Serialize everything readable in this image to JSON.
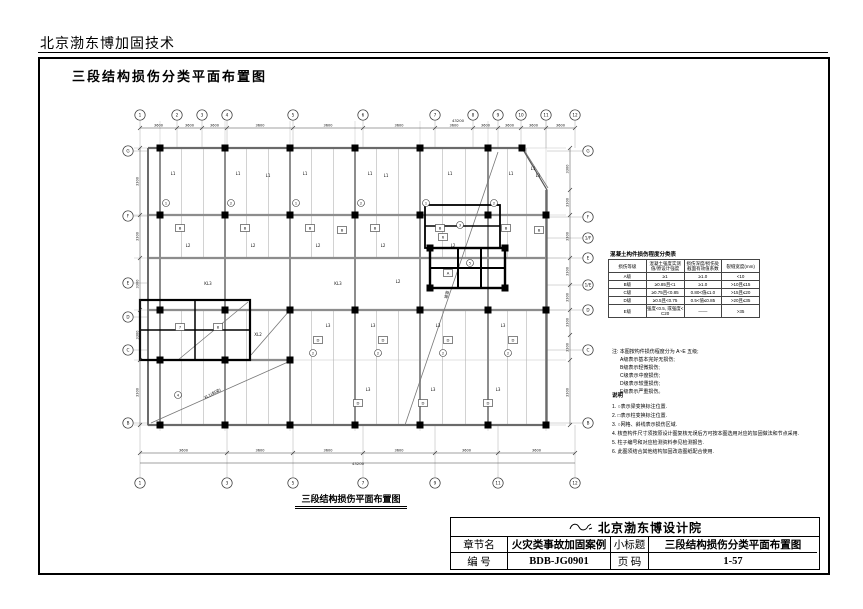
{
  "page": {
    "header_text": "北京渤东博加固技术"
  },
  "drawing": {
    "title": "三段结构损伤分类平面布置图"
  },
  "class_table": {
    "title": "混凝土构件损伤程度分类表",
    "headers": [
      "损伤等级",
      "混凝土强度实测值/原设计强度",
      "损伤深度/损伤处截面有效值系数",
      "裂缝宽度(mm)"
    ],
    "rows": [
      [
        "A级",
        "≥1",
        "≥1.0",
        "<10"
      ],
      [
        "B级",
        "≥0.85且<1",
        "≥1.0",
        ">10且≤15"
      ],
      [
        "C级",
        "≥0.75且<0.85",
        "0.80<值≤1.0",
        ">15且≤20"
      ],
      [
        "D级",
        "≥0.5且<0.75",
        "0.5<值≤0.85",
        ">20且≤35"
      ],
      [
        "E级",
        "强度<0.5, 或强度<C20",
        "——",
        ">35"
      ]
    ]
  },
  "notes": {
    "lead": "注: 本图按构件损伤程度分为 A~E 五级;",
    "items": [
      "A级表示基本完好无损伤;",
      "B级表示轻微损伤;",
      "C级表示中度损伤;",
      "D级表示较重损伤;",
      "E级表示严重损伤。"
    ]
  },
  "legend": {
    "title": "说明",
    "items": [
      "1. ○表示梁变换标注位置.",
      "2. □表示柱变换标注位置.",
      "3. ○网格、斜线表示损伤区域.",
      "4. 核查构件尺寸须按原设计图复核无误后方可按本图选用对应的加固做法和节点采用.",
      "5. 柱子编号和对应检测资料参见检测报告.",
      "6. 此图须结合其他结构加固改造图纸配合使用."
    ]
  },
  "titleblock": {
    "company": "北京渤东博设计院",
    "chapter_label": "章节名",
    "chapter": "火灾类事故加固案例",
    "subtitle_label": "小标题",
    "subtitle": "三段结构损伤分类平面布置图",
    "number_label": "编  号",
    "number": "BDB-JG0901",
    "page_label": "页  码",
    "page": "1-57"
  },
  "plan": {
    "caption": "三段结构损伤平面布置图",
    "beams": {
      "main_x": [
        42,
        107,
        172,
        237,
        302,
        370,
        428
      ],
      "main_y": [
        53,
        120,
        163,
        215,
        265,
        330
      ],
      "h": [
        [
          30,
          53,
          404
        ],
        [
          30,
          120,
          429
        ],
        [
          30,
          163,
          429
        ],
        [
          30,
          215,
          429
        ],
        [
          30,
          265,
          172
        ],
        [
          30,
          330,
          429
        ]
      ],
      "v": [
        [
          30,
          53,
          330
        ],
        [
          42,
          53,
          330
        ],
        [
          107,
          53,
          330
        ],
        [
          172,
          53,
          330
        ],
        [
          237,
          53,
          330
        ],
        [
          302,
          53,
          330
        ],
        [
          370,
          53,
          330
        ],
        [
          428,
          95,
          330
        ]
      ],
      "joist_bands": [
        [
          53,
          120
        ],
        [
          120,
          163
        ],
        [
          215,
          265
        ],
        [
          265,
          330
        ]
      ]
    },
    "outline": "30,53 404,53 429,95 429,330 30,330 30,53",
    "walls": [
      [
        340,
        153,
        340,
        193,
        2
      ],
      [
        363,
        153,
        363,
        193,
        2
      ],
      [
        312,
        173,
        387,
        173,
        2
      ],
      [
        77,
        205,
        77,
        265,
        1.5
      ],
      [
        22,
        235,
        132,
        235,
        1.5
      ],
      [
        307,
        131,
        382,
        131,
        1.5
      ]
    ],
    "thick_rects": [
      [
        312,
        153,
        75,
        40,
        2.4
      ],
      [
        307,
        110,
        75,
        43,
        1.8
      ],
      [
        22,
        205,
        110,
        60,
        2.2
      ]
    ],
    "diagonals": [
      [
        380,
        57,
        287,
        330
      ],
      [
        33,
        328,
        170,
        267
      ],
      [
        60,
        265,
        130,
        207
      ],
      [
        133,
        260,
        172,
        215
      ],
      [
        406,
        55,
        430,
        93
      ]
    ],
    "columns": [
      [
        42,
        53
      ],
      [
        107,
        53
      ],
      [
        172,
        53
      ],
      [
        237,
        53
      ],
      [
        302,
        53
      ],
      [
        370,
        53
      ],
      [
        404,
        53
      ],
      [
        42,
        120
      ],
      [
        107,
        120
      ],
      [
        172,
        120
      ],
      [
        237,
        120
      ],
      [
        302,
        120
      ],
      [
        370,
        120
      ],
      [
        428,
        120
      ],
      [
        42,
        215
      ],
      [
        107,
        215
      ],
      [
        172,
        215
      ],
      [
        237,
        215
      ],
      [
        302,
        215
      ],
      [
        370,
        215
      ],
      [
        428,
        215
      ],
      [
        42,
        265
      ],
      [
        107,
        265
      ],
      [
        172,
        265
      ],
      [
        42,
        330
      ],
      [
        107,
        330
      ],
      [
        172,
        330
      ],
      [
        237,
        330
      ],
      [
        302,
        330
      ],
      [
        370,
        330
      ],
      [
        428,
        330
      ],
      [
        312,
        153
      ],
      [
        387,
        153
      ],
      [
        312,
        193
      ],
      [
        387,
        193
      ]
    ],
    "bubbles": {
      "top": {
        "y": 20,
        "items": [
          {
            "x": 22,
            "label": "1"
          },
          {
            "x": 59,
            "label": "2"
          },
          {
            "x": 84,
            "label": "3"
          },
          {
            "x": 109,
            "label": "4"
          },
          {
            "x": 175,
            "label": "5"
          },
          {
            "x": 245,
            "label": "6"
          },
          {
            "x": 317,
            "label": "7"
          },
          {
            "x": 355,
            "label": "8"
          },
          {
            "x": 380,
            "label": "9"
          },
          {
            "x": 403,
            "label": "10"
          },
          {
            "x": 428,
            "label": "11"
          },
          {
            "x": 457,
            "label": "12"
          }
        ]
      },
      "bottom": {
        "y": 388,
        "items": [
          {
            "x": 22,
            "label": "1"
          },
          {
            "x": 109,
            "label": "3"
          },
          {
            "x": 175,
            "label": "5"
          },
          {
            "x": 245,
            "label": "7"
          },
          {
            "x": 317,
            "label": "9"
          },
          {
            "x": 380,
            "label": "11"
          },
          {
            "x": 457,
            "label": "12"
          }
        ]
      },
      "left": {
        "x": 10,
        "items": [
          {
            "y": 56,
            "label": "G"
          },
          {
            "y": 121,
            "label": "F"
          },
          {
            "y": 188,
            "label": "E"
          },
          {
            "y": 222,
            "label": "D"
          },
          {
            "y": 255,
            "label": "C"
          },
          {
            "y": 328,
            "label": "B"
          }
        ]
      },
      "right": {
        "x": 470,
        "items": [
          {
            "y": 56,
            "label": "G"
          },
          {
            "y": 122,
            "label": "F"
          },
          {
            "y": 143,
            "label": "1/F"
          },
          {
            "y": 163,
            "label": "E"
          },
          {
            "y": 190,
            "label": "1/E"
          },
          {
            "y": 215,
            "label": "D"
          },
          {
            "y": 255,
            "label": "C"
          },
          {
            "y": 328,
            "label": "B"
          }
        ]
      }
    },
    "dims": {
      "top": {
        "y": 33,
        "ticks": [
          22,
          59,
          84,
          109,
          175,
          245,
          317,
          355,
          380,
          403,
          428,
          457
        ],
        "value": "3600",
        "overall": "43200",
        "overall_x": 340,
        "overall_y": 27
      },
      "bottom": {
        "y": 358,
        "ticks": [
          22,
          109,
          175,
          245,
          317,
          380,
          457
        ],
        "value": "3600",
        "overall": "43200",
        "overall_x": 240,
        "overall_y": 370
      },
      "left": {
        "x": 22,
        "ticks": [
          53,
          120,
          163,
          215,
          265,
          330
        ],
        "value": "3300"
      },
      "right": {
        "x": 452,
        "ticks": [
          53,
          95,
          120,
          163,
          190,
          215,
          240,
          265,
          330
        ],
        "value": "3300"
      }
    },
    "labels": [
      {
        "x": 55,
        "y": 80,
        "t": "L1"
      },
      {
        "x": 120,
        "y": 80,
        "t": "L1"
      },
      {
        "x": 150,
        "y": 82,
        "t": "L1"
      },
      {
        "x": 187,
        "y": 80,
        "t": "L1"
      },
      {
        "x": 252,
        "y": 80,
        "t": "L1"
      },
      {
        "x": 268,
        "y": 82,
        "t": "L1"
      },
      {
        "x": 332,
        "y": 80,
        "t": "L1"
      },
      {
        "x": 393,
        "y": 80,
        "t": "L1"
      },
      {
        "x": 420,
        "y": 82,
        "t": "L1"
      },
      {
        "x": 415,
        "y": 75,
        "t": "L1"
      },
      {
        "x": 62,
        "y": 133,
        "t": "B",
        "k": "b"
      },
      {
        "x": 127,
        "y": 133,
        "t": "B",
        "k": "b"
      },
      {
        "x": 192,
        "y": 133,
        "t": "B",
        "k": "b"
      },
      {
        "x": 224,
        "y": 135,
        "t": "B",
        "k": "b"
      },
      {
        "x": 257,
        "y": 133,
        "t": "B",
        "k": "b"
      },
      {
        "x": 322,
        "y": 133,
        "t": "B",
        "k": "b"
      },
      {
        "x": 388,
        "y": 133,
        "t": "B",
        "k": "b"
      },
      {
        "x": 421,
        "y": 135,
        "t": "B",
        "k": "b"
      },
      {
        "x": 48,
        "y": 108,
        "t": "1",
        "k": "c"
      },
      {
        "x": 113,
        "y": 108,
        "t": "2",
        "k": "c"
      },
      {
        "x": 178,
        "y": 108,
        "t": "1",
        "k": "c"
      },
      {
        "x": 243,
        "y": 108,
        "t": "2",
        "k": "c"
      },
      {
        "x": 308,
        "y": 108,
        "t": "1",
        "k": "c"
      },
      {
        "x": 376,
        "y": 108,
        "t": "2",
        "k": "c"
      },
      {
        "x": 70,
        "y": 152,
        "t": "L2"
      },
      {
        "x": 135,
        "y": 152,
        "t": "L2"
      },
      {
        "x": 200,
        "y": 152,
        "t": "L2"
      },
      {
        "x": 265,
        "y": 152,
        "t": "L2"
      },
      {
        "x": 335,
        "y": 152,
        "t": "L2"
      },
      {
        "x": 90,
        "y": 190,
        "t": "KL3"
      },
      {
        "x": 220,
        "y": 190,
        "t": "KL3"
      },
      {
        "x": 280,
        "y": 188,
        "t": "L2"
      },
      {
        "x": 330,
        "y": 178,
        "t": "A",
        "k": "b"
      },
      {
        "x": 352,
        "y": 168,
        "t": "5",
        "k": "c"
      },
      {
        "x": 325,
        "y": 142,
        "t": "6",
        "k": "b"
      },
      {
        "x": 342,
        "y": 130,
        "t": "3",
        "k": "c"
      },
      {
        "x": 62,
        "y": 232,
        "t": "7",
        "k": "b"
      },
      {
        "x": 100,
        "y": 232,
        "t": "8",
        "k": "b"
      },
      {
        "x": 140,
        "y": 241,
        "t": "XL2"
      },
      {
        "x": 200,
        "y": 245,
        "t": "D",
        "k": "b"
      },
      {
        "x": 265,
        "y": 245,
        "t": "D",
        "k": "b"
      },
      {
        "x": 330,
        "y": 245,
        "t": "D",
        "k": "b"
      },
      {
        "x": 395,
        "y": 245,
        "t": "D",
        "k": "b"
      },
      {
        "x": 210,
        "y": 232,
        "t": "L3"
      },
      {
        "x": 255,
        "y": 232,
        "t": "L3"
      },
      {
        "x": 320,
        "y": 232,
        "t": "L3"
      },
      {
        "x": 385,
        "y": 232,
        "t": "L3"
      },
      {
        "x": 195,
        "y": 258,
        "t": "2",
        "k": "c"
      },
      {
        "x": 260,
        "y": 258,
        "t": "2",
        "k": "c"
      },
      {
        "x": 325,
        "y": 258,
        "t": "2",
        "k": "c"
      },
      {
        "x": 390,
        "y": 258,
        "t": "2",
        "k": "c"
      },
      {
        "x": 240,
        "y": 308,
        "t": "D",
        "k": "b"
      },
      {
        "x": 305,
        "y": 308,
        "t": "D",
        "k": "b"
      },
      {
        "x": 370,
        "y": 308,
        "t": "D",
        "k": "b"
      },
      {
        "x": 250,
        "y": 296,
        "t": "L3"
      },
      {
        "x": 315,
        "y": 296,
        "t": "L3"
      },
      {
        "x": 380,
        "y": 296,
        "t": "L3"
      },
      {
        "x": 95,
        "y": 300,
        "t": "XL1(斜梁)",
        "r": -27
      },
      {
        "x": 330,
        "y": 200,
        "t": "坡道",
        "r": -75
      },
      {
        "x": 60,
        "y": 300,
        "t": "4",
        "k": "c"
      }
    ]
  }
}
